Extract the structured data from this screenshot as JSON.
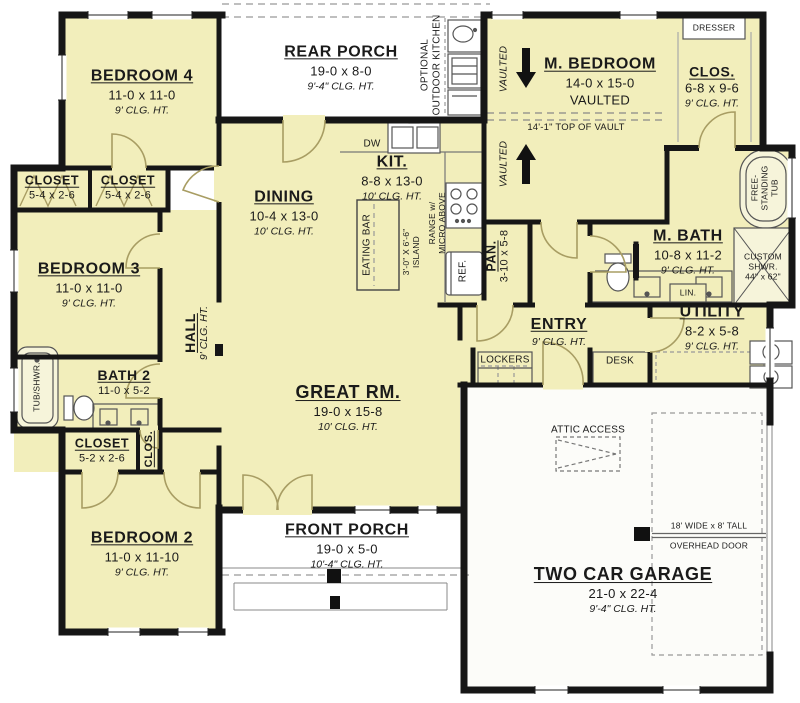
{
  "plan": {
    "rooms": {
      "bedroom4": {
        "name": "BEDROOM 4",
        "dims": "11-0 x 11-0",
        "clg": "9' CLG. HT."
      },
      "rear_porch": {
        "name": "REAR PORCH",
        "dims": "19-0 x 8-0",
        "clg": "9'-4\" CLG. HT."
      },
      "m_bedroom": {
        "name": "M. BEDROOM",
        "dims": "14-0 x 15-0",
        "extra": "VAULTED"
      },
      "m_clos": {
        "name": "CLOS.",
        "dims": "6-8 x 9-6",
        "clg": "9' CLG. HT."
      },
      "dining": {
        "name": "DINING",
        "dims": "10-4 x 13-0",
        "clg": "10' CLG. HT."
      },
      "kit": {
        "name": "KIT.",
        "dims": "8-8 x 13-0",
        "clg": "10' CLG. HT."
      },
      "bedroom3": {
        "name": "BEDROOM 3",
        "dims": "11-0 x 11-0",
        "clg": "9' CLG. HT."
      },
      "closet1": {
        "name": "CLOSET",
        "dims": "5-4 x 2-6"
      },
      "closet2": {
        "name": "CLOSET",
        "dims": "5-4 x 2-6"
      },
      "hall": {
        "name": "HALL",
        "clg": "9' CLG. HT."
      },
      "bath2": {
        "name": "BATH 2",
        "dims": "11-0 x 5-2"
      },
      "closet3": {
        "name": "CLOSET",
        "dims": "5-2 x 2-6"
      },
      "clos_hall": {
        "name": "CLOS."
      },
      "m_bath": {
        "name": "M. BATH",
        "dims": "10-8 x 11-2",
        "clg": "9' CLG. HT."
      },
      "pan": {
        "name": "PAN.",
        "dims": "3-10 x 5-8"
      },
      "entry": {
        "name": "ENTRY",
        "clg": "9' CLG. HT."
      },
      "utility": {
        "name": "UTILITY",
        "dims": "8-2 x 5-8",
        "clg": "9' CLG. HT."
      },
      "great_rm": {
        "name": "GREAT RM.",
        "dims": "19-0 x 15-8",
        "clg": "10' CLG. HT."
      },
      "bedroom2": {
        "name": "BEDROOM 2",
        "dims": "11-0 x 11-10",
        "clg": "9' CLG. HT."
      },
      "front_porch": {
        "name": "FRONT PORCH",
        "dims": "19-0 x 5-0",
        "clg": "10'-4\" CLG. HT."
      },
      "garage": {
        "name": "TWO CAR GARAGE",
        "dims": "21-0 x 22-4",
        "clg": "9'-4\" CLG. HT."
      }
    },
    "annotations": {
      "dw": "DW",
      "eating_bar": "EATING BAR",
      "island_l1": "3'-0\" X 6'-6\"",
      "island_l2": "ISLAND",
      "range_l1": "RANGE w/",
      "range_l2": "MICRO ABOVE",
      "ref": "REF.",
      "outdoor_l1": "OPTIONAL",
      "outdoor_l2": "OUTDOOR KITCHEN",
      "vaulted": "VAULTED",
      "top_of_vault": "14'-1\" TOP OF VAULT",
      "dresser": "DRESSER",
      "free_tub_l1": "FREE-",
      "free_tub_l2": "STANDING",
      "free_tub_l3": "TUB",
      "custom_l1": "CUSTOM",
      "custom_l2": "SHWR.",
      "custom_l3": "44\" x 62\"",
      "lin": "LIN.",
      "tub_shwr": "TUB/SHWR.",
      "lockers": "LOCKERS",
      "desk": "DESK",
      "attic": "ATTIC ACCESS",
      "ohd_l1": "18' WIDE x 8' TALL",
      "ohd_l2": "OVERHEAD DOOR"
    },
    "colors": {
      "room_fill": "#f2eebb",
      "wall": "#161616",
      "door": "#a89d63",
      "dash": "#8a8a8a"
    }
  }
}
